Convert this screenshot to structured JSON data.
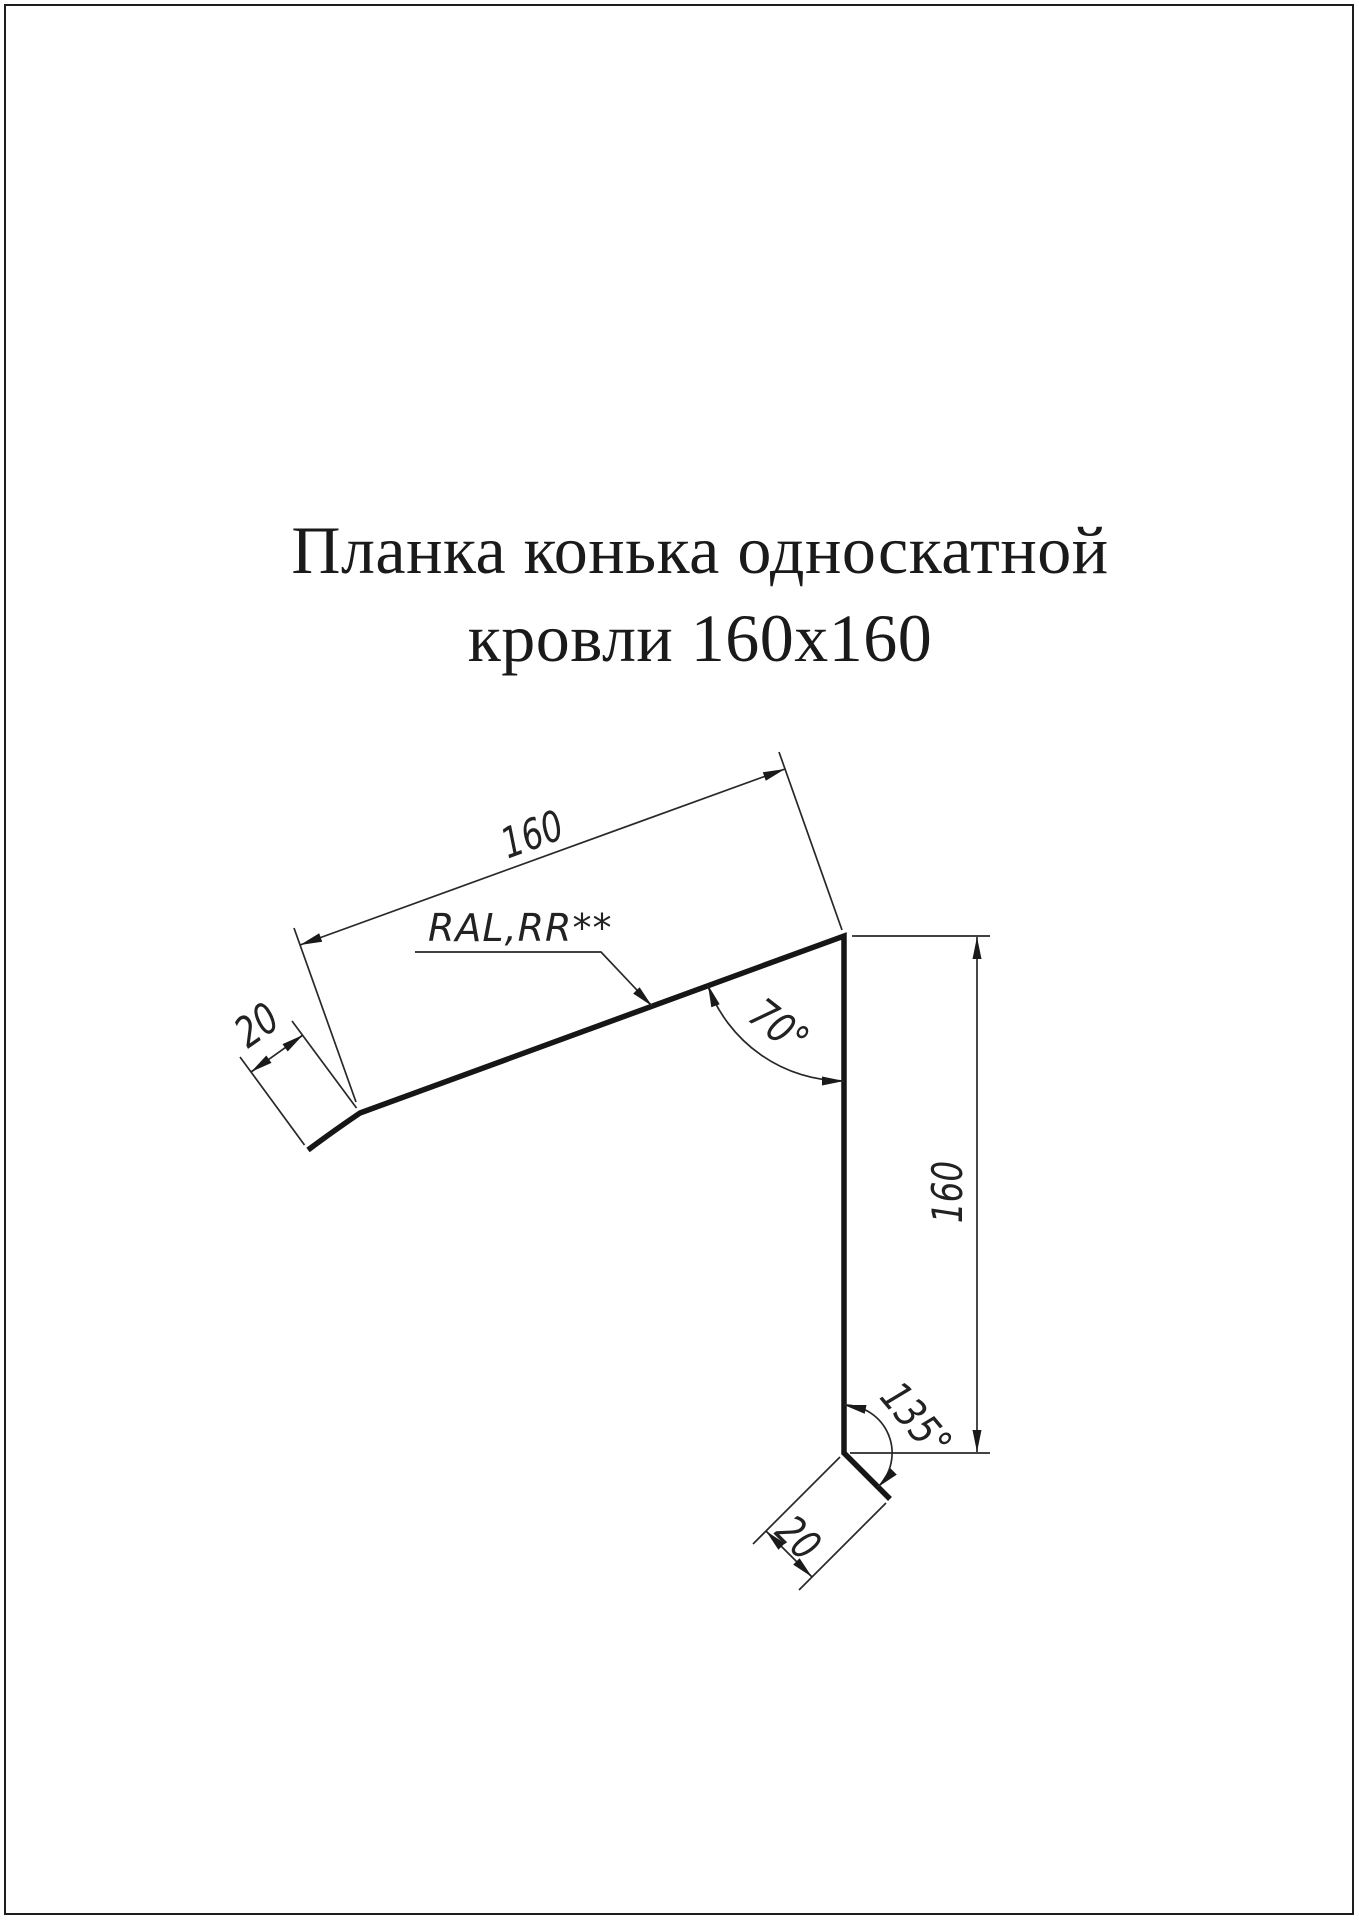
{
  "title": {
    "line1": "Планка конька односкатной",
    "line2": "кровли 160х160"
  },
  "drawing": {
    "dim_top_length": "160",
    "dim_top_hem": "20",
    "material_label": "RAL,RR**",
    "angle_top": "70°",
    "dim_right_height": "160",
    "angle_bottom": "135°",
    "dim_bottom_hem": "20"
  },
  "colors": {
    "line": "#1a1a1a",
    "background": "#ffffff"
  }
}
